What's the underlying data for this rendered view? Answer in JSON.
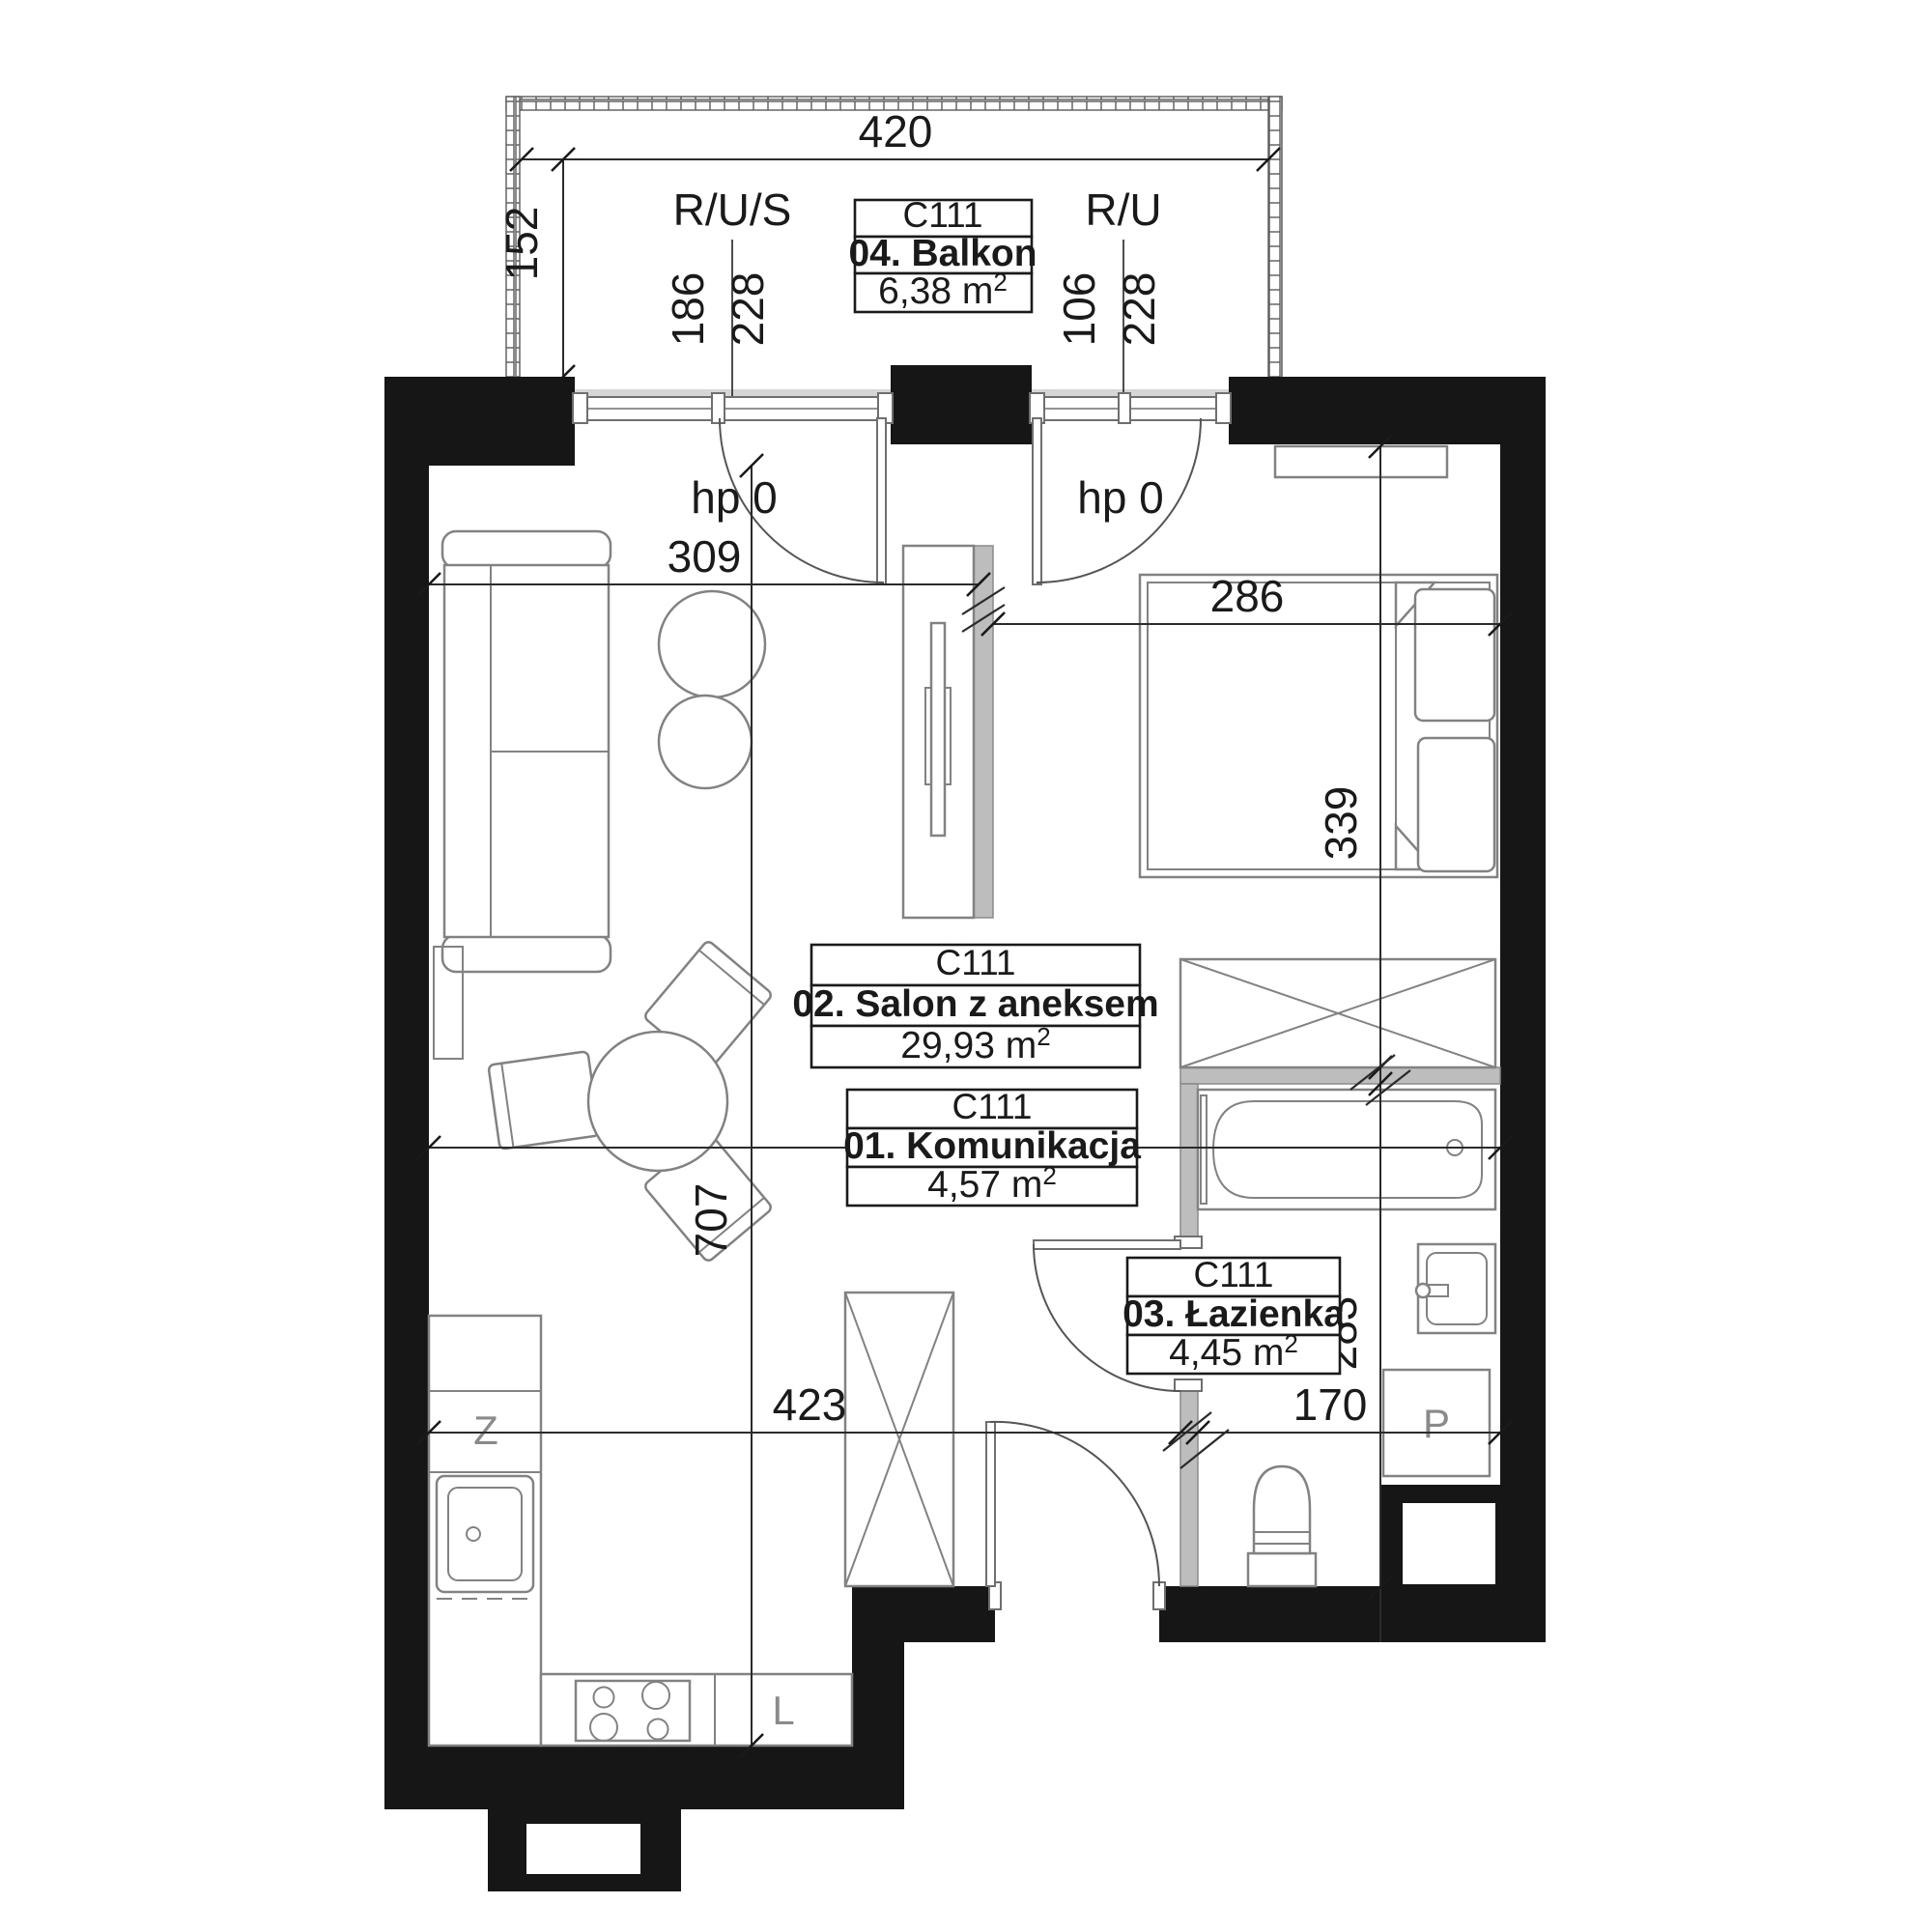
{
  "plan": {
    "unit_code": "C111",
    "risers": {
      "left": "R/U/S",
      "right": "R/U"
    },
    "window_labels": {
      "left": "hp 0",
      "right": "hp 0"
    },
    "appliance_labels": {
      "kitchen_sink": "Z",
      "fridge": "L",
      "washing_machine": "P"
    },
    "dims": {
      "balcony_width": "420",
      "balcony_depth": "152",
      "win_left_w": "186",
      "win_left_h": "228",
      "win_right_w": "106",
      "win_right_h": "228",
      "salon_width": "309",
      "bedroom_width": "286",
      "bed_zone_depth": "339",
      "interior_width": "603",
      "interior_depth": "707",
      "kitchen_run": "423",
      "entry_width": "170",
      "bath_depth": "283"
    },
    "rooms": {
      "balkon": {
        "code": "C111",
        "name": "04. Balkon",
        "area_label": "6,38 m",
        "area_sup": "2"
      },
      "salon": {
        "code": "C111",
        "name": "02. Salon z aneksem",
        "area_label": "29,93 m",
        "area_sup": "2"
      },
      "komunikacja": {
        "code": "C111",
        "name": "01. Komunikacja",
        "area_label": "4,57 m",
        "area_sup": "2"
      },
      "lazienka": {
        "code": "C111",
        "name": "03. Łazienka",
        "area_label": "4,45 m",
        "area_sup": "2"
      }
    }
  }
}
